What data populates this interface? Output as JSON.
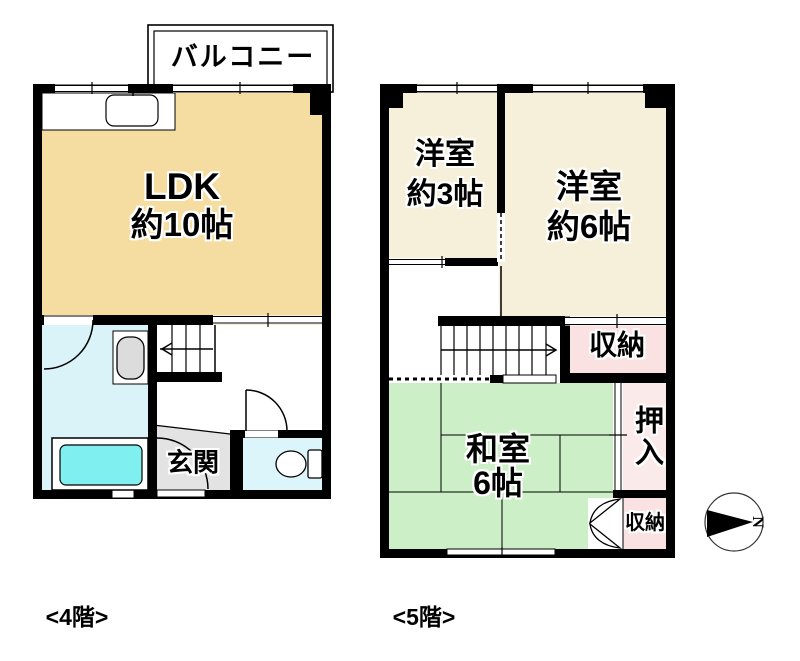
{
  "floors": {
    "f4": {
      "floor_label": "<4階>",
      "balcony_label": "バルコニー",
      "rooms": {
        "ldk": {
          "name": "LDK",
          "size": "約10帖"
        },
        "genkan": {
          "name": "玄関"
        }
      }
    },
    "f5": {
      "floor_label": "<5階>",
      "rooms": {
        "western3": {
          "name": "洋室",
          "size": "約3帖"
        },
        "western6": {
          "name": "洋室",
          "size": "約6帖"
        },
        "tatami": {
          "name": "和室",
          "size": "6帖"
        },
        "storage_upper": {
          "name": "収納"
        },
        "oshiire": {
          "name": "押入"
        },
        "storage_lower": {
          "name": "収納"
        }
      }
    }
  },
  "compass": {
    "north_label": "N"
  },
  "colors": {
    "ldk_fill": "#F5DCA1",
    "western_room_fill": "#F6F0DA",
    "tatami_fill": "#CDEFC8",
    "storage_fill": "#F9E2E1",
    "oshiire_fill": "#FBEAEA",
    "bathroom_fill": "#D9F3F8",
    "toilet_room_fill": "#DCF5FA",
    "bathtub_fill": "#7FEFEF",
    "genkan_fill": "#E3E3E3",
    "wall": "#000000"
  }
}
